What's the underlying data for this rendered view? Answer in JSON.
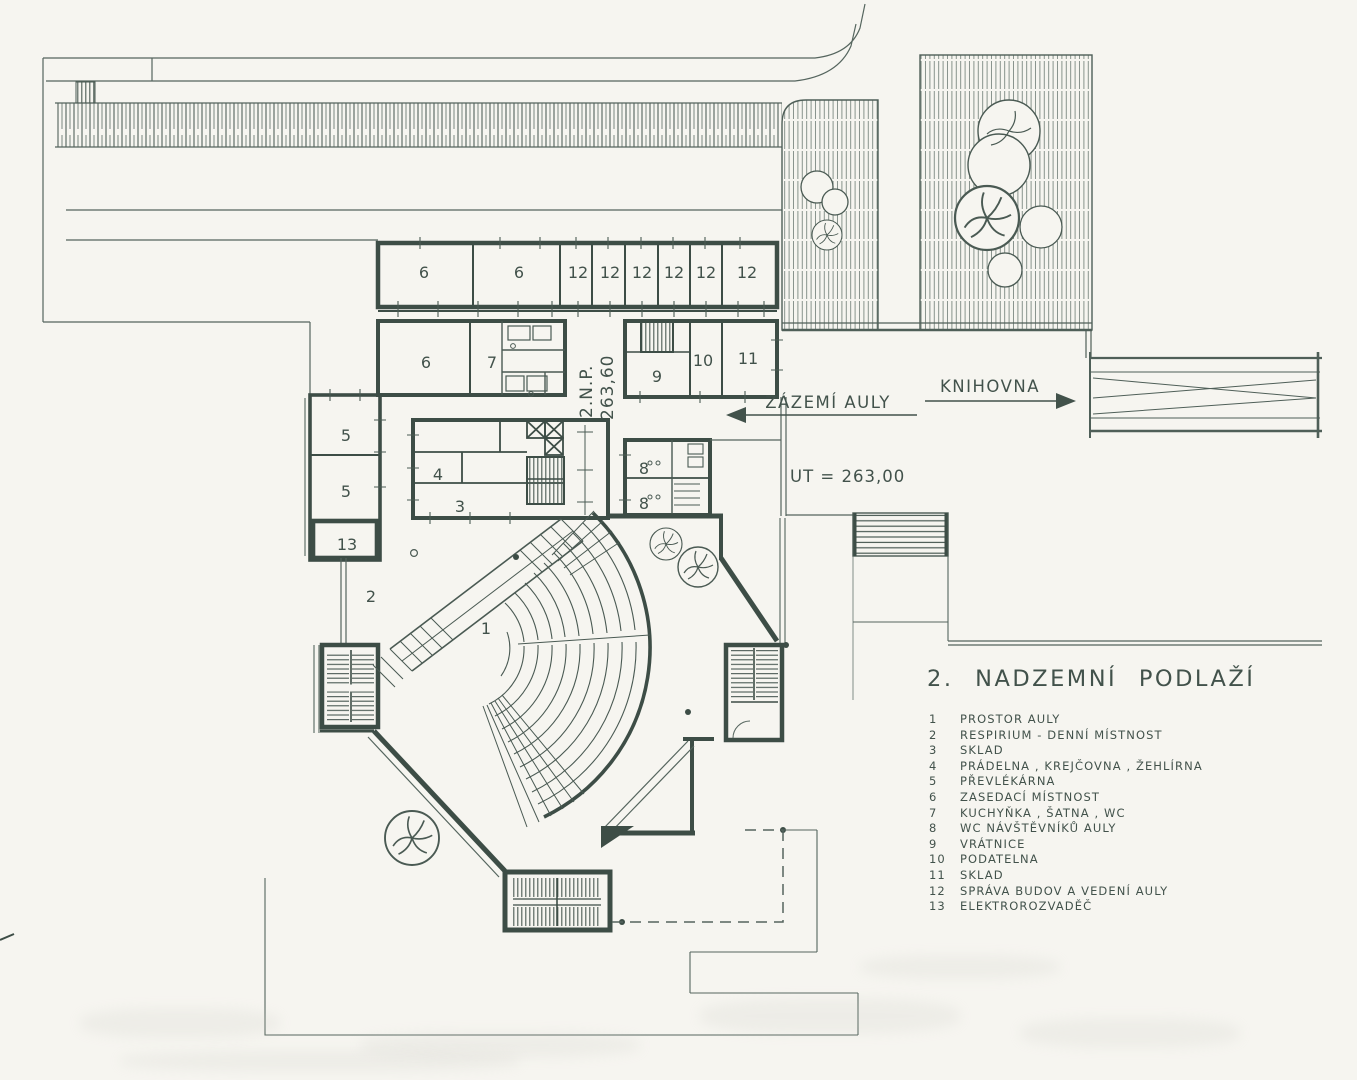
{
  "drawing": {
    "title": "2. NADZEMNÍ PODLAŽÍ",
    "wayfinding": {
      "backstage": "ZÁZEMÍ AULY",
      "library": "KNIHOVNA"
    },
    "levels": {
      "floor_mark": "2.N.P.",
      "floor_elevation": "263,60",
      "terrain": "UT = 263,00"
    },
    "legend": [
      {
        "num": "1",
        "label": "PROSTOR AULY"
      },
      {
        "num": "2",
        "label": "RESPIRIUM - DENNÍ MÍSTNOST"
      },
      {
        "num": "3",
        "label": "SKLAD"
      },
      {
        "num": "4",
        "label": "PRÁDELNA , KREJČOVNA , ŽEHLÍRNA"
      },
      {
        "num": "5",
        "label": "PŘEVLÉKÁRNA"
      },
      {
        "num": "6",
        "label": "ZASEDACÍ MÍSTNOST"
      },
      {
        "num": "7",
        "label": "KUCHYŇKA , ŠATNA , WC"
      },
      {
        "num": "8",
        "label": "WC NÁVŠTĚVNÍKŮ AULY"
      },
      {
        "num": "9",
        "label": "VRÁTNICE"
      },
      {
        "num": "10",
        "label": "PODATELNA"
      },
      {
        "num": "11",
        "label": "SKLAD"
      },
      {
        "num": "12",
        "label": "SPRÁVA BUDOV A VEDENÍ AULY"
      },
      {
        "num": "13",
        "label": "ELEKTROROZVADĚČ"
      }
    ],
    "plan_rooms": [
      {
        "n": "6"
      },
      {
        "n": "6"
      },
      {
        "n": "12"
      },
      {
        "n": "12"
      },
      {
        "n": "12"
      },
      {
        "n": "12"
      },
      {
        "n": "12"
      },
      {
        "n": "12"
      },
      {
        "n": "6"
      },
      {
        "n": "7"
      },
      {
        "n": "9"
      },
      {
        "n": "10"
      },
      {
        "n": "11"
      },
      {
        "n": "5"
      },
      {
        "n": "5"
      },
      {
        "n": "13"
      },
      {
        "n": "4"
      },
      {
        "n": "3"
      },
      {
        "n": "8"
      },
      {
        "n": "8"
      },
      {
        "n": "2"
      },
      {
        "n": "1"
      }
    ],
    "colors": {
      "ink": "#46564f",
      "wall": "#3d4d46",
      "paper": "#f6f5f0"
    }
  }
}
